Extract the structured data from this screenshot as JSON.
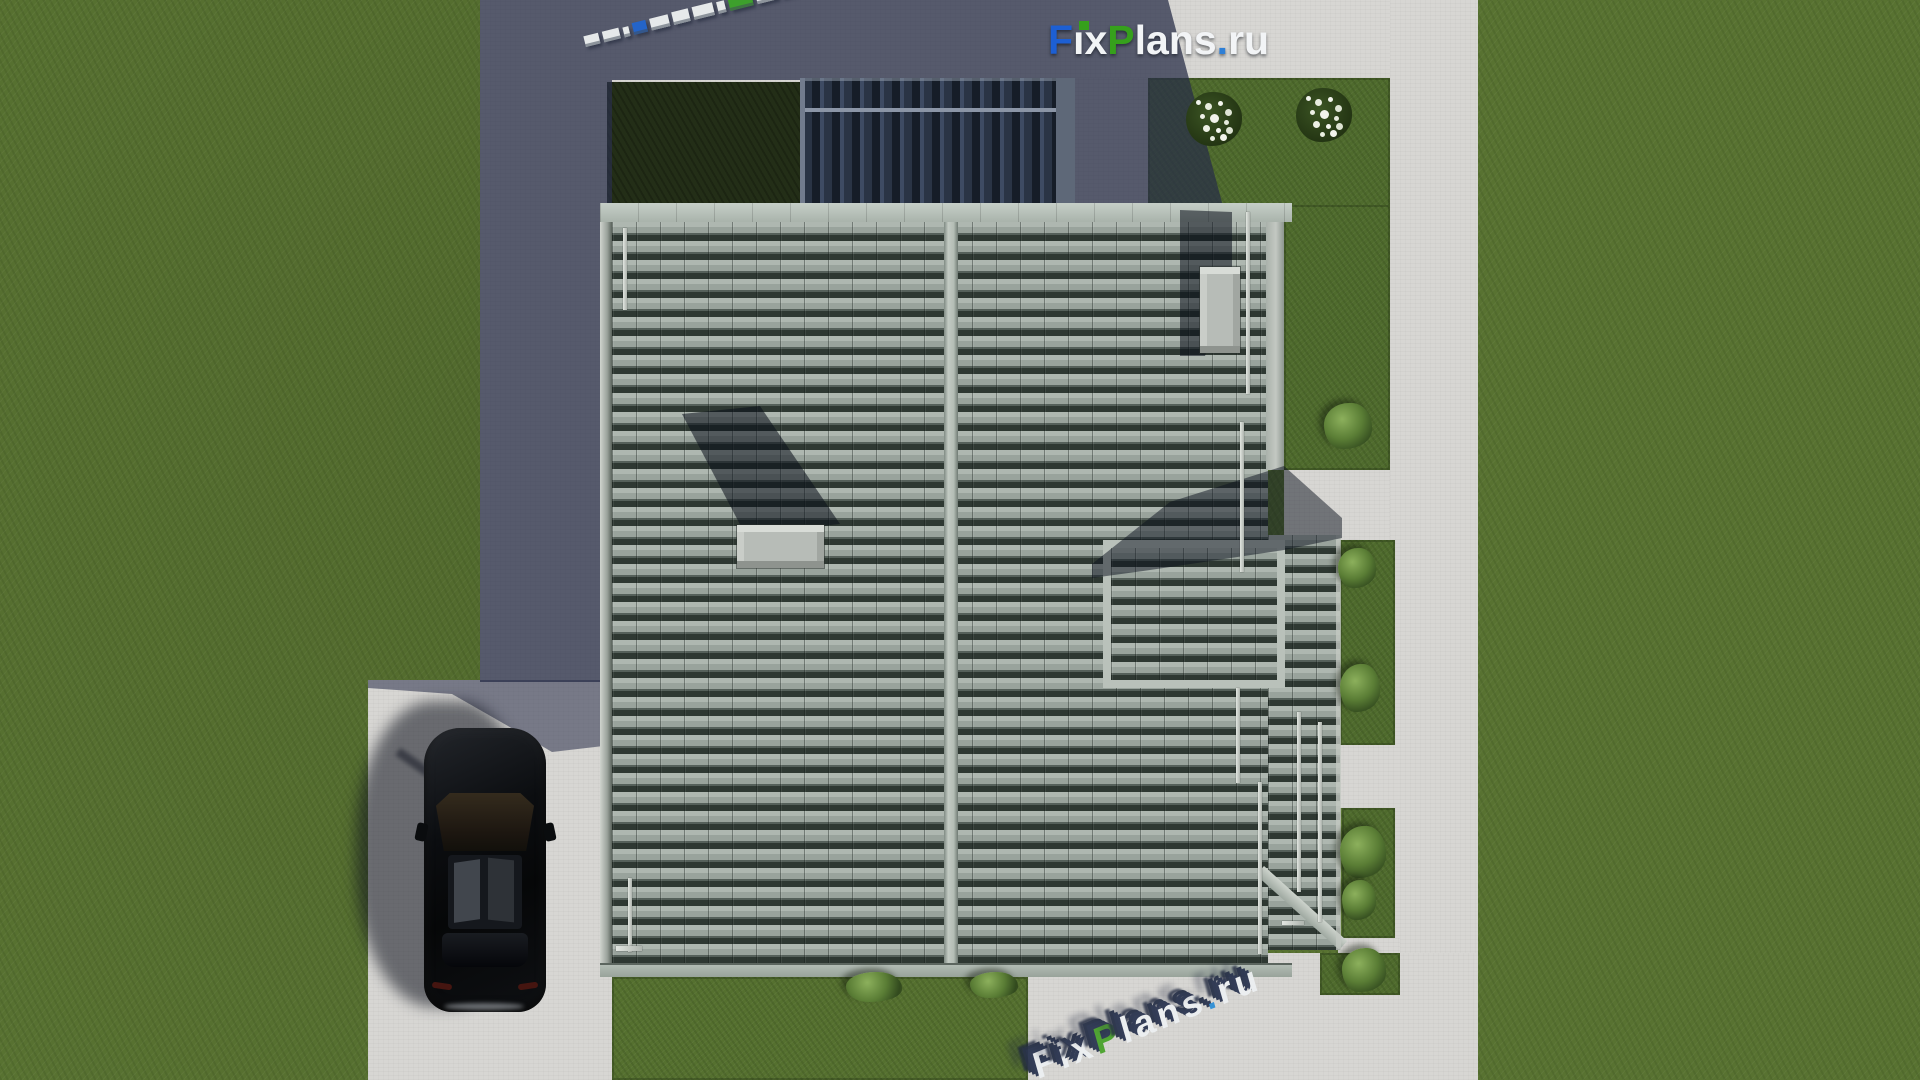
{
  "brand": {
    "logo_text": "FixPlans.ru",
    "logo_segments": [
      {
        "t": "F",
        "c": "#1d5fd3"
      },
      {
        "t": "ı",
        "c": "#f2f4f6"
      },
      {
        "t": "x",
        "c": "#f2f4f6"
      },
      {
        "t": "P",
        "c": "#36a01c"
      },
      {
        "t": "lans",
        "c": "#f2f4f6"
      },
      {
        "t": ".",
        "c": "#2e7fd6"
      },
      {
        "t": "ru",
        "c": "#f2f4f6"
      }
    ]
  },
  "watermark_bottom": {
    "text": "FixPlans.ru",
    "segments": [
      {
        "t": "F",
        "c": "#edf0f2"
      },
      {
        "t": "i",
        "c": "#edf0f2"
      },
      {
        "t": "x",
        "c": "#edf0f2"
      },
      {
        "t": "P",
        "c": "#4aa32c"
      },
      {
        "t": "lans",
        "c": "#edf0f2"
      },
      {
        "t": ".",
        "c": "#2e8fd6"
      },
      {
        "t": "ru",
        "c": "#edf0f2"
      }
    ]
  },
  "watermark_top_strip": {
    "meaning": "FixPlans.ru 3d letter blocks lying on ground",
    "blocks": [
      {
        "w": 16,
        "h": 11,
        "c": "#e6e9ea"
      },
      {
        "w": 18,
        "h": 11,
        "c": "#e6e9ea"
      },
      {
        "w": 6,
        "h": 10,
        "c": "#e6e9ea"
      },
      {
        "w": 14,
        "h": 12,
        "c": "#2464c8"
      },
      {
        "w": 20,
        "h": 12,
        "c": "#e6e9ea"
      },
      {
        "w": 18,
        "h": 13,
        "c": "#e6e9ea"
      },
      {
        "w": 22,
        "h": 13,
        "c": "#e6e9ea"
      },
      {
        "w": 8,
        "h": 12,
        "c": "#e6e9ea"
      },
      {
        "w": 26,
        "h": 14,
        "c": "#3da02c"
      },
      {
        "w": 22,
        "h": 14,
        "c": "#e6e9ea"
      },
      {
        "w": 16,
        "h": 14,
        "c": "#e6e9ea"
      },
      {
        "w": 10,
        "h": 13,
        "c": "#3da02c"
      },
      {
        "w": 26,
        "h": 21,
        "c": "#2a6ad0"
      }
    ]
  },
  "scene": {
    "type": "top-down architectural 3d render",
    "house": {
      "roof": "large gabled tile roof, vertical ridge, two skylights",
      "roof_tile_color": "#9aa49d",
      "ridge_color": "#b9c3bb",
      "clerestory": "dark slate upper roof section in shadow",
      "skylight_count": 2
    },
    "car": {
      "color": "black",
      "type": "SUV seen from above",
      "location": "driveway lower left"
    },
    "vegetation": {
      "flowering_bushes": 2,
      "green_bushes": 8,
      "grass_color": "#587231",
      "shaded_courtyard_color": "#232e17"
    },
    "ground": {
      "concrete_color": "#d7d6d3",
      "shadow_overlay": "rgba(40,46,72,0.74)",
      "paths": [
        "top band",
        "left strip",
        "driveway",
        "right path",
        "bottom walk"
      ]
    }
  }
}
